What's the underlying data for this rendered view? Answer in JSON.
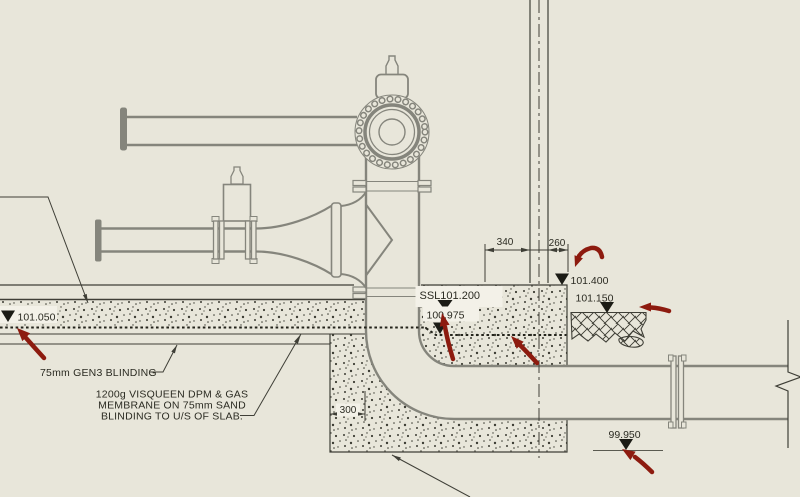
{
  "colors": {
    "background": "#e8e6da",
    "pipe_gray": "#85857c",
    "ink": "#3f3f37",
    "markup_red": "#8d1b0f",
    "label_mask": "#f3f1e8"
  },
  "glyphs": {
    "level_marker": "▼",
    "leader_arrow": "➤"
  },
  "levels": {
    "left_slab": "101.050",
    "ssl": "SSL101.200",
    "membrane": "100.975",
    "plinth_top": "101.400",
    "hardcore": "101.150",
    "invert": "99.950"
  },
  "dimensions": {
    "left_span": "340",
    "right_span": "260",
    "upstand": "300"
  },
  "notes": {
    "blinding": "75mm GEN3 BLINDING",
    "membrane_1": "1200g VISQUEEN DPM & GAS",
    "membrane_2": "MEMBRANE ON 75mm SAND",
    "membrane_3": "BLINDING TO U/S OF SLAB."
  }
}
